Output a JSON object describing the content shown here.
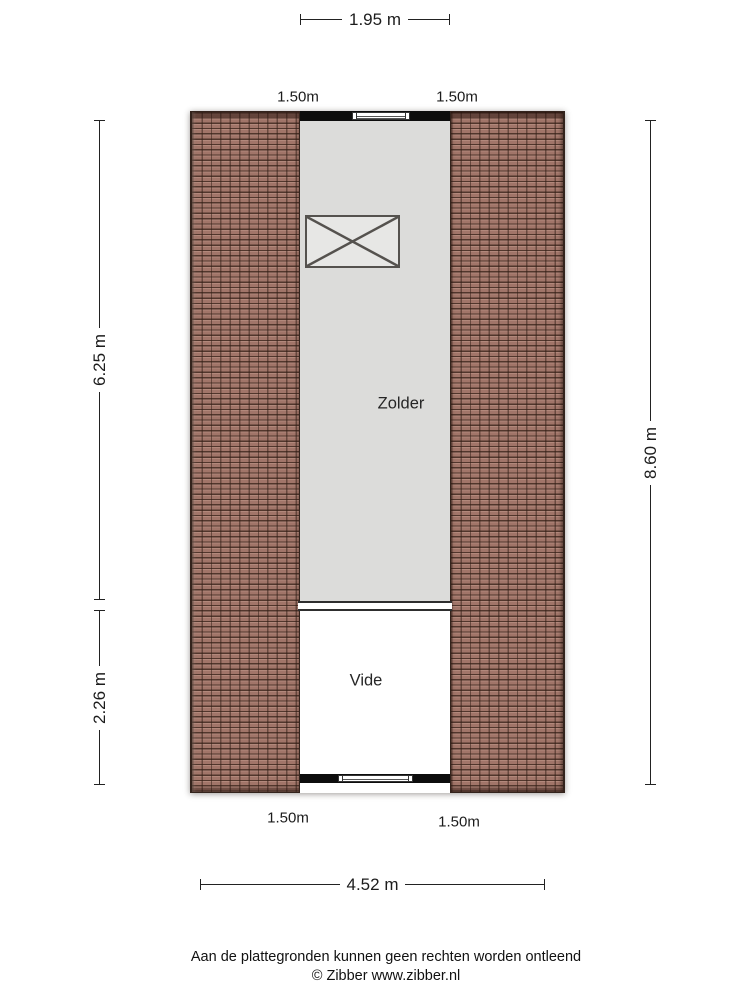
{
  "plan": {
    "rooms": [
      {
        "label": "Zolder"
      },
      {
        "label": "Vide"
      }
    ]
  },
  "dimensions": {
    "top_width": "1.95 m",
    "top_roof_left": "1.50m",
    "top_roof_right": "1.50m",
    "side_left_upper": "6.25 m",
    "side_left_lower": "2.26 m",
    "side_right": "8.60 m",
    "bottom_roof_left": "1.50m",
    "bottom_roof_right": "1.50m",
    "bottom_width": "4.52 m"
  },
  "footer": {
    "disclaimer": "Aan de plattegronden kunnen geen rechten worden ontleend",
    "copyright": "© Zibber www.zibber.nl"
  },
  "colors": {
    "roof_tile": "#a6796c",
    "floor_zolder": "#dcdcda",
    "floor_vide": "#ffffff",
    "wall": "#0d0d0d",
    "dimension_text": "#1c1c1c"
  }
}
